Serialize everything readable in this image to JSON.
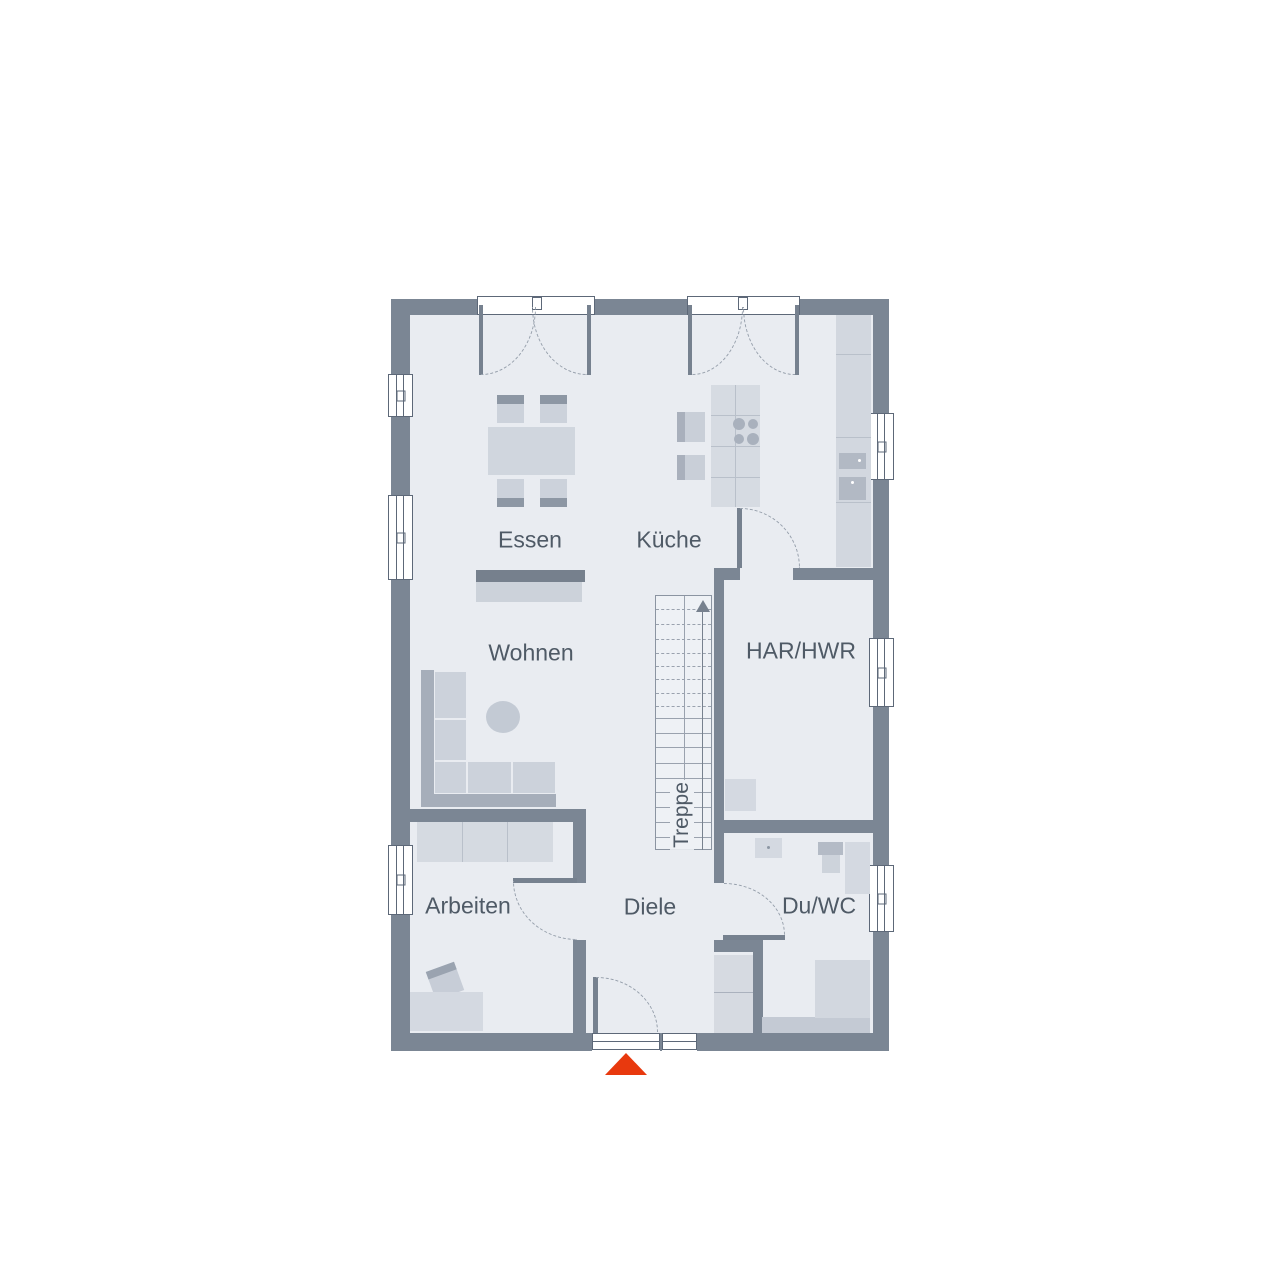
{
  "diagram": {
    "type": "floor-plan",
    "rooms": {
      "essen": {
        "label": "Essen"
      },
      "kueche": {
        "label": "Küche"
      },
      "wohnen": {
        "label": "Wohnen"
      },
      "har_hwr": {
        "label": "HAR/HWR"
      },
      "arbeiten": {
        "label": "Arbeiten"
      },
      "diele": {
        "label": "Diele"
      },
      "du_wc": {
        "label": "Du/WC"
      },
      "treppe": {
        "label": "Treppe"
      }
    },
    "stairs": {
      "direction": "up"
    },
    "entrance": {
      "marker": "triangle-up"
    },
    "colors": {
      "wall": "#7b8694",
      "floor": "#e9ecf1",
      "furniture_light": "#d4d9e1",
      "furniture_medium": "#c7cdd7",
      "accent_dark": "#8d97a4",
      "entrance_arrow": "#e8390e",
      "label_text": "#4f5a66"
    }
  }
}
